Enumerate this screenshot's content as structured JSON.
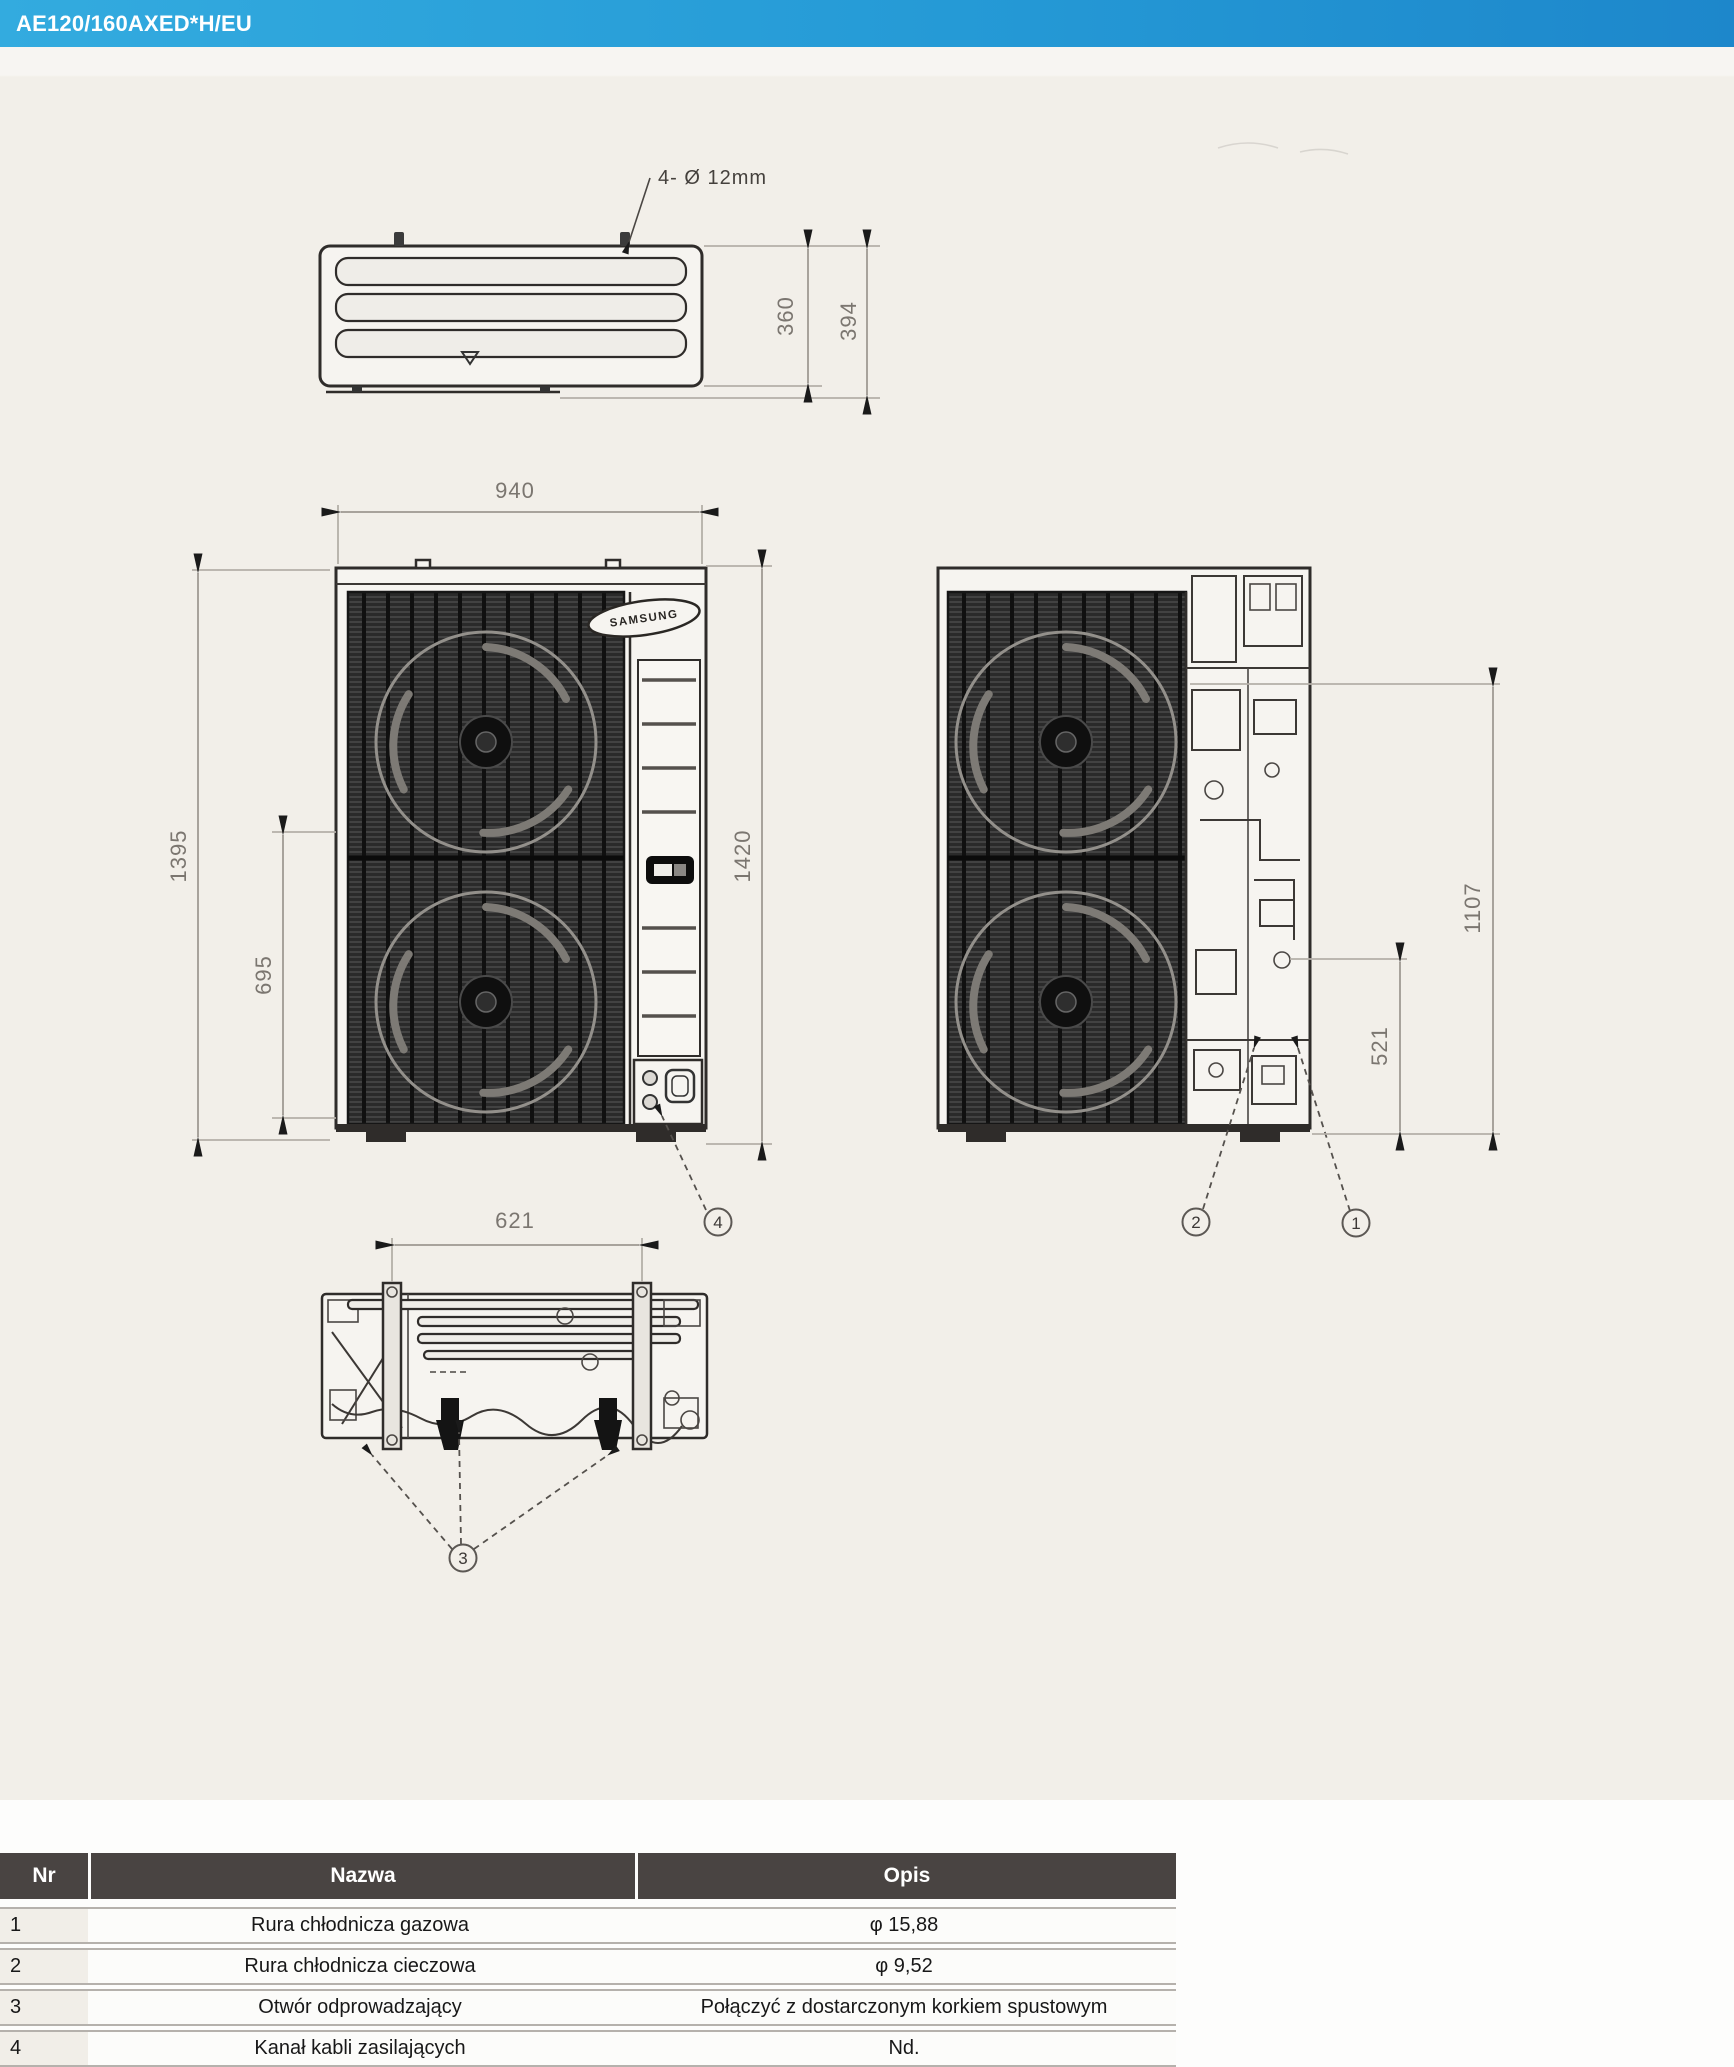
{
  "header": {
    "model": "AE120/160AXED*H/EU"
  },
  "drawing": {
    "logo": "SAMSUNG",
    "note_bolt": "4- Ø 12mm",
    "dims": {
      "d360": "360",
      "d394": "394",
      "w940": "940",
      "h1395": "1395",
      "h695": "695",
      "h1420": "1420",
      "s1107": "1107",
      "s521": "521",
      "b621": "621"
    },
    "balloons": {
      "b1": "1",
      "b2": "2",
      "b3": "3",
      "b4": "4"
    }
  },
  "table": {
    "columns": {
      "nr": "Nr",
      "nazwa": "Nazwa",
      "opis": "Opis"
    },
    "rows": [
      {
        "nr": "1",
        "nazwa": "Rura chłodnicza gazowa",
        "opis": "φ 15,88"
      },
      {
        "nr": "2",
        "nazwa": "Rura chłodnicza cieczowa",
        "opis": "φ 9,52"
      },
      {
        "nr": "3",
        "nazwa": "Otwór odprowadzający",
        "opis": "Połączyć z dostarczonym korkiem spustowym"
      },
      {
        "nr": "4",
        "nazwa": "Kanał kabli zasilających",
        "opis": "Nd."
      }
    ]
  },
  "colors": {
    "header_blue_start": "#33abdf",
    "header_blue_end": "#1d87cb",
    "table_header_bg": "#494442",
    "paper": "#f2efe9",
    "dimension_gray": "#a8a39c"
  }
}
